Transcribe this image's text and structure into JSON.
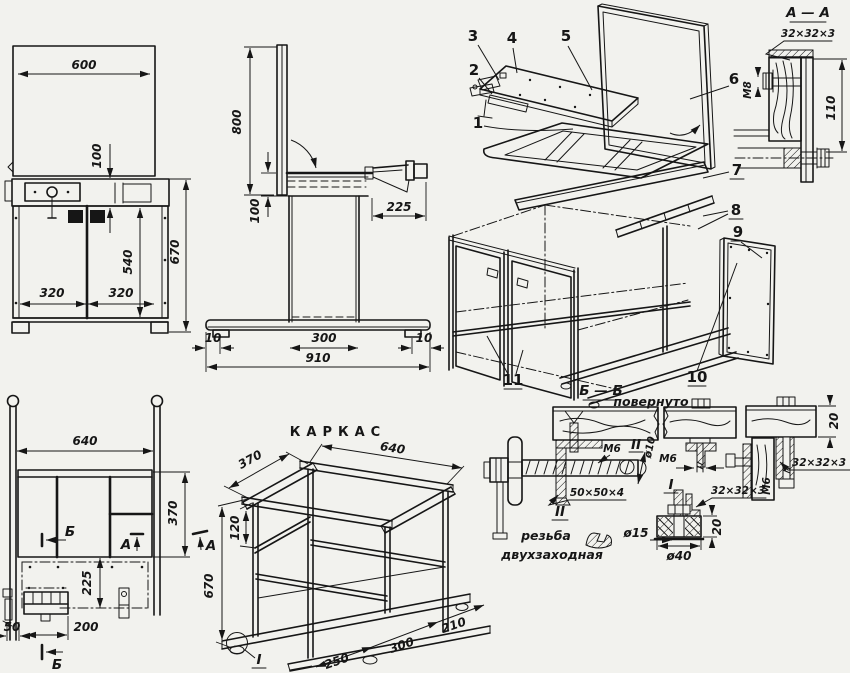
{
  "front_view": {
    "top_width": "600",
    "apron_height": "100",
    "door_height": "540",
    "total_height": "670",
    "door_left": "320",
    "door_right": "320"
  },
  "side_view": {
    "panel_height": "800",
    "apron_height": "100",
    "bracket_depth": "225",
    "overhang_left": "10",
    "pedestal_depth": "300",
    "base_length": "910",
    "overhang_right": "10"
  },
  "plan_view": {
    "frame_width": "640",
    "frame_depth": "370",
    "slide_offset": "225",
    "block_width": "200",
    "foot_width": "50",
    "marker_b_top": "Б",
    "marker_a": "А",
    "marker_b_bottom": "Б"
  },
  "frame_iso": {
    "title": "КАРКАС",
    "depth": "370",
    "width": "640",
    "rail_offset": "120",
    "height": "670",
    "runner_seg1": "250",
    "runner_seg2": "300",
    "runner_seg3": "210",
    "detail_ref": "I",
    "marker_a": "А"
  },
  "exploded_view": {
    "callouts": [
      "1",
      "2",
      "3",
      "4",
      "5",
      "6",
      "7",
      "8",
      "9",
      "10",
      "11"
    ]
  },
  "section_aa": {
    "title": "А — А",
    "angle_profile": "32×32×3",
    "bolt": "М8",
    "height": "110"
  },
  "section_bb": {
    "title": "Б — Б",
    "modifier": "повернуто",
    "detail_ref_i": "I",
    "clamp": {
      "thread": "М6",
      "detail_ref": "II",
      "rod_diameter": "ø10",
      "plate": "50×50×4",
      "note_ref": "II",
      "note_line1": "резьба",
      "note_line2": "двухзаходная"
    },
    "joint": {
      "board_thickness": "20",
      "thread_left": "М6",
      "angle_profile": "32×32×3",
      "thread_vertical": "М6",
      "angle_profile_2": "32×32×3"
    }
  },
  "detail_i": {
    "pad_height": "20",
    "bolt_diameter": "ø15",
    "pad_diameter": "ø40"
  }
}
